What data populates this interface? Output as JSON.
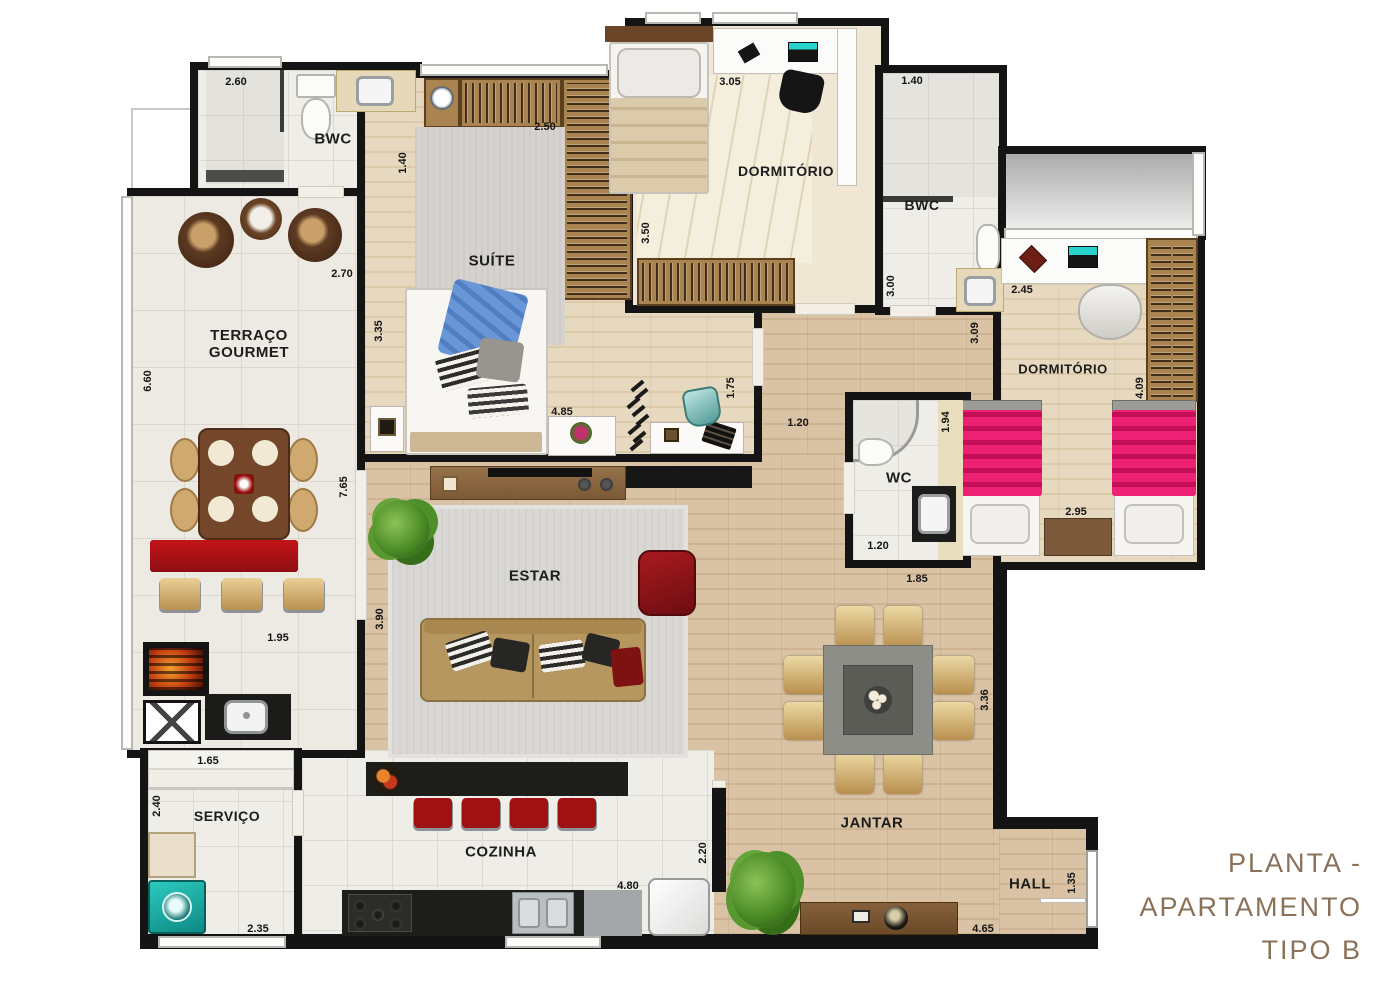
{
  "title": {
    "lines": [
      "PLANTA -",
      "APARTAMENTO",
      "TIPO B"
    ],
    "color": "#8a7158"
  },
  "rooms": {
    "bwc1": {
      "label": "BWC"
    },
    "terraco": {
      "label": "TERRAÇO GOURMET"
    },
    "suite": {
      "label": "SUÍTE"
    },
    "dorm1": {
      "label": "DORMITÓRIO"
    },
    "bwc2": {
      "label": "BWC"
    },
    "dorm2": {
      "label": "DORMITÓRIO"
    },
    "wc": {
      "label": "WC"
    },
    "estar": {
      "label": "ESTAR"
    },
    "jantar": {
      "label": "JANTAR"
    },
    "cozinha": {
      "label": "COZINHA"
    },
    "servico": {
      "label": "SERVIÇO"
    },
    "hall": {
      "label": "HALL"
    }
  },
  "dims": {
    "bwc1_w": "2.60",
    "bwc1_d": "1.40",
    "suite_closet": "2.50",
    "terraco_top": "2.70",
    "dorm1_w": "3.05",
    "dorm1_d": "3.50",
    "bwc2_w": "1.40",
    "bwc2_d": "3.00",
    "dorm2_left": "3.09",
    "dorm2_top": "2.45",
    "dorm2_right": "4.09",
    "dorm2_bottom": "2.95",
    "terraco_left": "6.60",
    "terraco_right": "7.65",
    "terraco_bottom": "1.95",
    "suite_left": "3.35",
    "suite_bottom": "4.85",
    "suite_door": "1.75",
    "corridor": "1.20",
    "wc_right": "1.94",
    "wc_bottom": "1.20",
    "wc_below": "1.85",
    "jantar_right": "3.36",
    "estar_left": "3.90",
    "servico_top": "1.65",
    "servico_left": "2.40",
    "servico_bottom": "2.35",
    "cozinha_right": "2.20",
    "cozinha_bottom": "4.80",
    "hall_right": "1.35",
    "hall_bottom": "4.65"
  },
  "colors": {
    "wall": "#141414",
    "accent_red": "#a31216",
    "floor_wood": "#d9c3a4",
    "tile": "#efede7",
    "bed_pink": "#e8196e",
    "teal": "#18a8a1",
    "title_brown": "#8a7158"
  }
}
